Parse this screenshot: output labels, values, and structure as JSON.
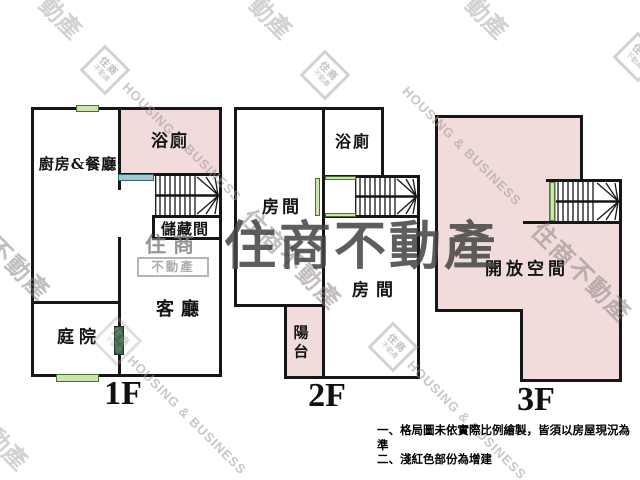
{
  "floors": [
    {
      "label": "1F",
      "rooms": {
        "kitchen_dining": "廚房&餐廳",
        "bath": "浴廁",
        "storage": "儲藏間",
        "living": "客廳",
        "yard": "庭院"
      }
    },
    {
      "label": "2F",
      "rooms": {
        "room_a": "房間",
        "bath": "浴廁",
        "room_b": "房間",
        "balcony": "陽台"
      }
    },
    {
      "label": "3F",
      "rooms": {
        "open_space": "開放空間"
      }
    }
  ],
  "notes": [
    "一、格局圖未依實際比例繪製，皆須以房屋現況為準",
    "二、淺紅色部份為增建"
  ],
  "watermark": {
    "brand": "住商不動產",
    "brand_en": "HOUSING & BUSINESS",
    "logo_line1": "住商",
    "logo_line2": "不動產",
    "fragment": "動產"
  },
  "colors": {
    "pink": "#f1dbdb",
    "wall": "#161616",
    "green-light": "#cde4ad",
    "green-dark": "#47712e",
    "door-green": "#3f684d",
    "teal": "#a3c8cf",
    "teal-dark": "#2e666e"
  }
}
